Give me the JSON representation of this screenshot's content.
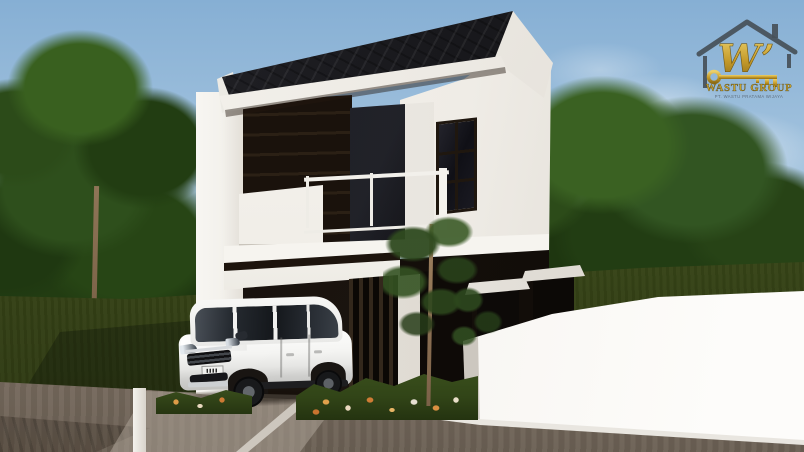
{
  "scene": {
    "type": "3d-architecture-exterior-render",
    "description": "3D exterior render of a modern minimalist two-storey house: white walls with dark wood accent panels, black gable roof, glass balcony with white railing, carport with a white MPV parked in front, vertical slat entry screen, gate pillars with white caps, white perimeter wall, ornamental tree and flower bed, green lawn, dense background trees under a light blue sky, paved road in the foreground",
    "elements": [
      "black gable roof",
      "white two-storey facade",
      "dark wood panel wall",
      "balcony with white railing",
      "grid window",
      "carport",
      "white MPV car",
      "vertical slat entrance screen",
      "gate pillars with white caps",
      "white perimeter wall",
      "ornamental tree",
      "flower bed with orange and white flowers",
      "lawn",
      "background trees",
      "paved road",
      "developer logo"
    ]
  },
  "logo": {
    "monogram": "W’",
    "brand": "WASTU GROUP",
    "tagline": "PT. WASTU PRATAMA WIJAYA",
    "gold_color": "#c7a22c",
    "outline_color": "#475058"
  },
  "palette": {
    "sky_top": "#86afd4",
    "sky_horizon": "#d8e4ee",
    "tree_green_dark": "#1f3811",
    "tree_green_light": "#39601f",
    "lawn_green": "#3c4d1a",
    "road_brown": "#8a7c6e",
    "house_white": "#f4f2ee",
    "roof_black": "#1a1a1e",
    "wood_panel": "#201710",
    "glass_dark": "#111116",
    "car_white": "#f2f2f0",
    "wall_white": "#f7f5f1"
  }
}
